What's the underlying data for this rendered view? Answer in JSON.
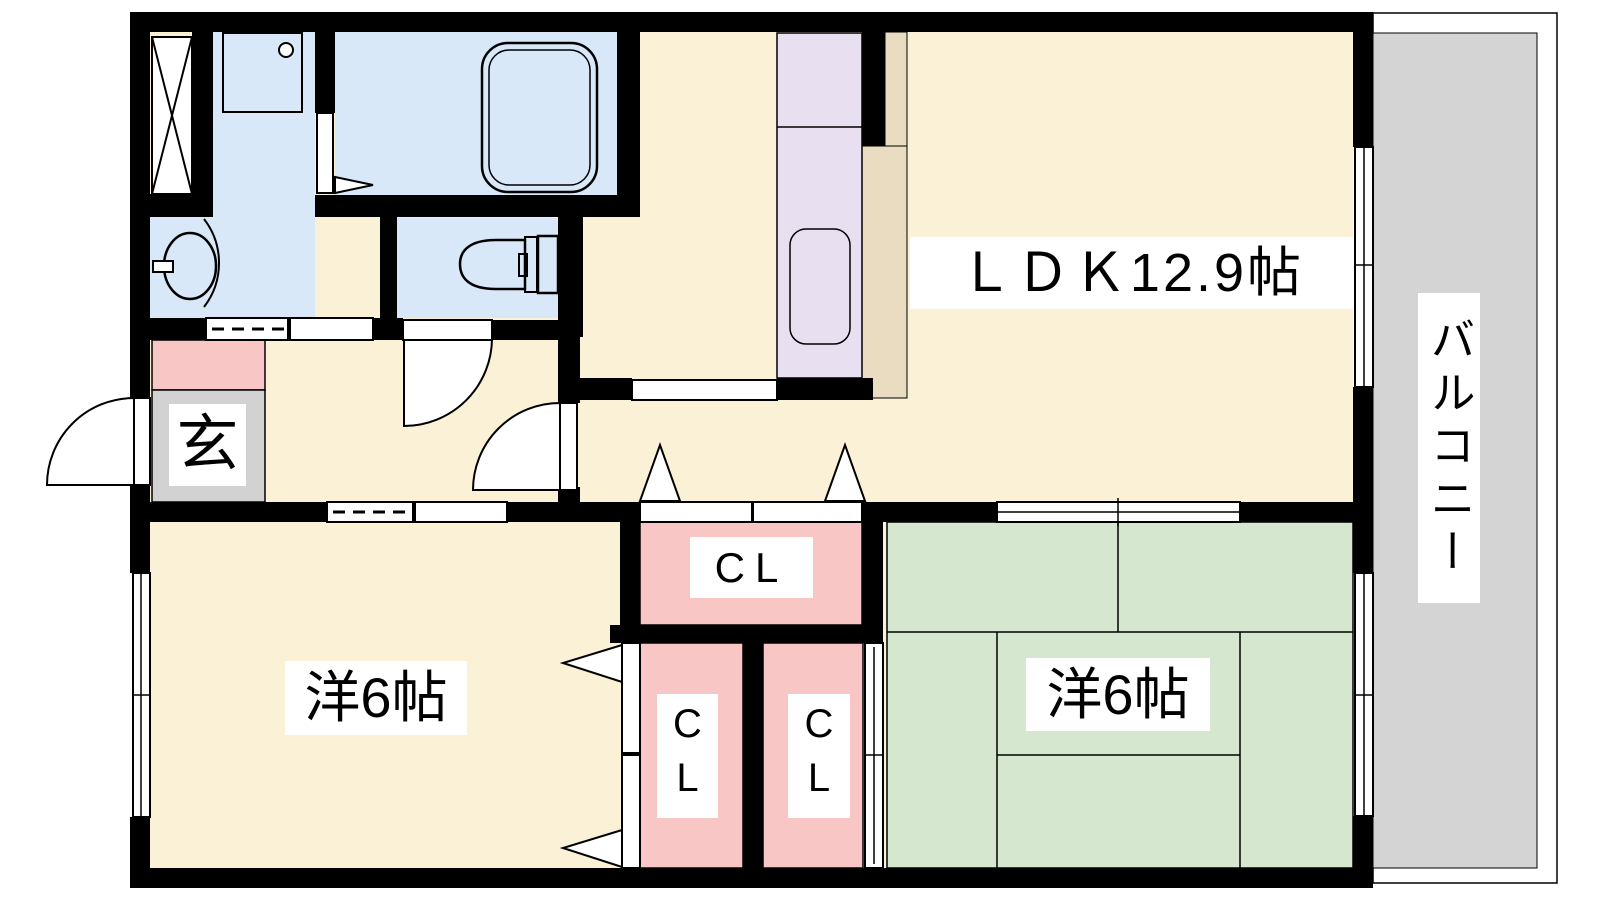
{
  "colors": {
    "floor-cream": "#fbf1d7",
    "floor-tan": "#e9dcc0",
    "counter-lavender": "#e8e0f1",
    "sanitary-blue": "#d9e8f8",
    "closet-pink": "#f9c6c6",
    "tatami-green": "#d6e7d0",
    "balcony-gray": "#d4d4d4",
    "entrance-gray": "#d2d2d2",
    "wall-black": "#000000"
  },
  "rooms": {
    "ldk": {
      "label": "ＬＤＫ12.9帖"
    },
    "balcony": {
      "label": "バルコニー"
    },
    "entrance": {
      "label": "玄"
    },
    "western_room_left": {
      "label": "洋6帖"
    },
    "western_room_right": {
      "label": "洋6帖"
    },
    "closet_hall": {
      "label": "CL"
    },
    "closet_lower_left": {
      "label": "CL"
    },
    "closet_lower_right": {
      "label": "CL"
    }
  }
}
